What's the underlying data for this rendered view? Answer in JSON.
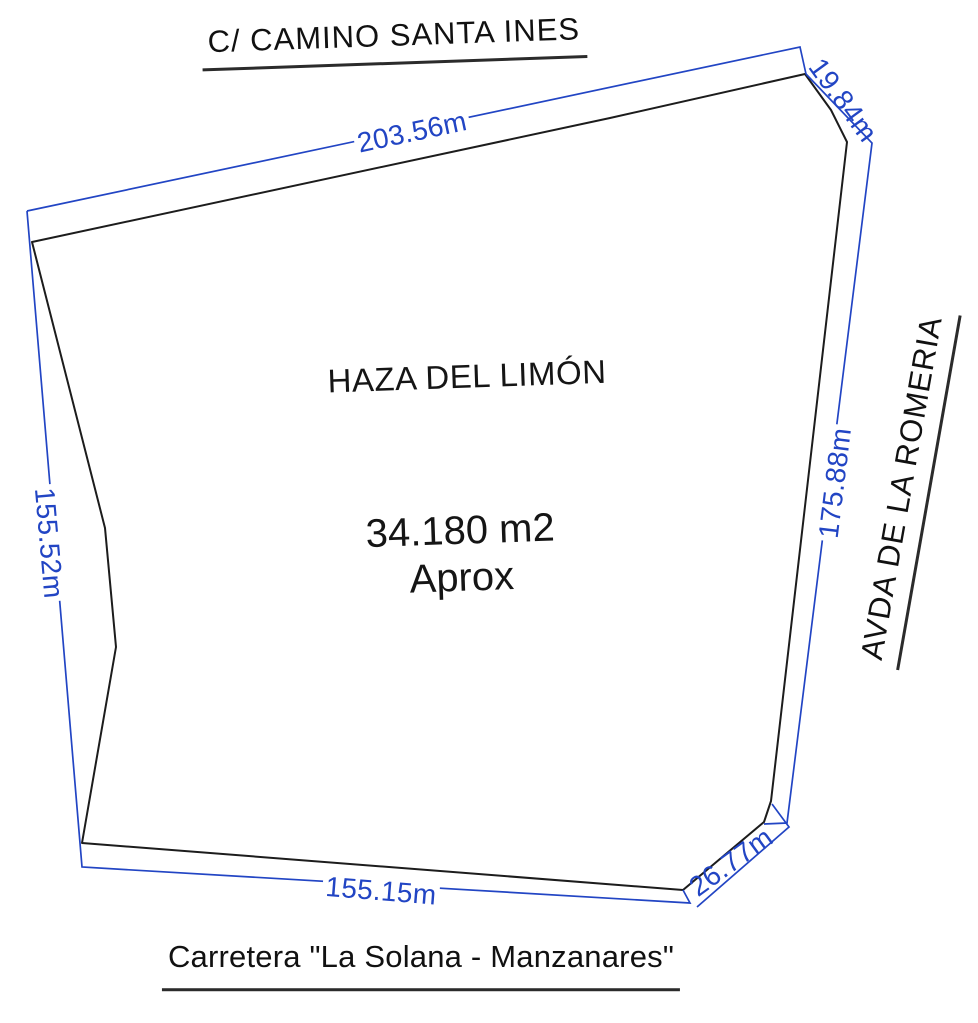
{
  "streets": {
    "top": "C/ CAMINO SANTA INES",
    "right": "AVDA DE LA ROMERIA",
    "bottom": "Carretera \"La Solana - Manzanares\""
  },
  "parcel": {
    "name": "HAZA DEL LIMÓN",
    "area": "34.180 m2",
    "area_note": "Aprox"
  },
  "dimensions": {
    "top": "203.56m",
    "top_right": "19.84m",
    "right": "175.88m",
    "bottom_right": "26.77m",
    "bottom": "155.15m",
    "left": "155.52m"
  },
  "colors": {
    "dimension_blue": "#2245c4",
    "outline_black": "#1c1c1c",
    "background": "#ffffff"
  }
}
